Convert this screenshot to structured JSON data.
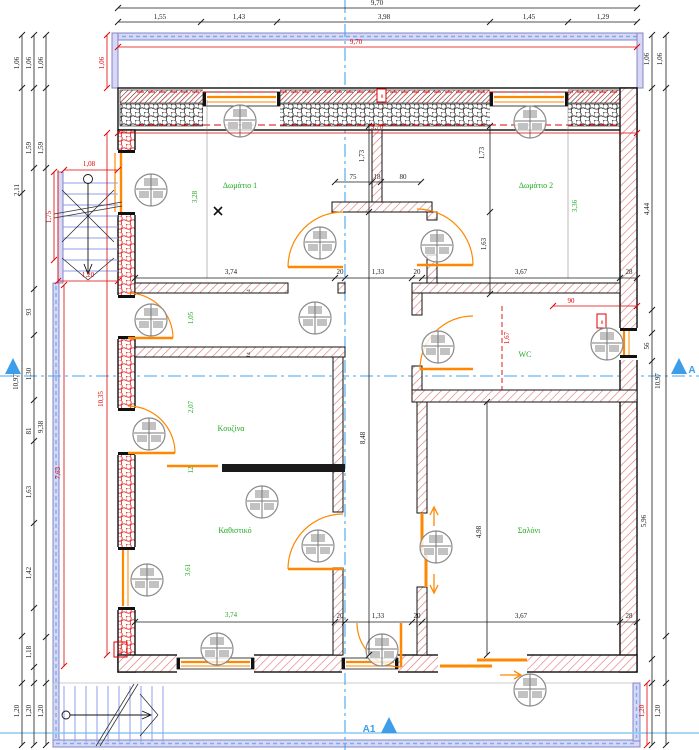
{
  "colors": {
    "dim_black": "#1a1a1a",
    "dim_red": "#e00000",
    "room_green": "#1faa1f",
    "section_blue": "#3d9de8",
    "door_orange": "#ff8800",
    "rail_purple": "#8585c8",
    "wall_hatch_red": "#e07070",
    "stair_tread_blue": "#8f9fe8"
  },
  "rooms": [
    {
      "label": "Δωμάτιο 1",
      "x": 240,
      "y": 188
    },
    {
      "label": "Δωμάτιο 2",
      "x": 536,
      "y": 188
    },
    {
      "label": "WC",
      "x": 525,
      "y": 357
    },
    {
      "label": "Κουζίνα",
      "x": 231,
      "y": 431
    },
    {
      "label": "Καθιστικό",
      "x": 235,
      "y": 533
    },
    {
      "label": "Σαλόνι",
      "x": 529,
      "y": 533
    }
  ],
  "markers": [
    {
      "t": "A",
      "x": 692,
      "y": 373
    },
    {
      "t": "A1",
      "x": 369,
      "y": 732
    }
  ],
  "dims": [
    {
      "t": "9,70",
      "x": 377,
      "y": 5,
      "c": "k"
    },
    {
      "t": "1,55",
      "x": 160,
      "y": 19,
      "c": "k"
    },
    {
      "t": "1,43",
      "x": 239,
      "y": 19,
      "c": "k"
    },
    {
      "t": "3,98",
      "x": 384,
      "y": 19,
      "c": "k"
    },
    {
      "t": "1,45",
      "x": 529,
      "y": 19,
      "c": "k"
    },
    {
      "t": "1,29",
      "x": 603,
      "y": 19,
      "c": "k"
    },
    {
      "t": "1,06",
      "x": 19,
      "y": 63,
      "r": 1,
      "c": "k"
    },
    {
      "t": "1,06",
      "x": 31,
      "y": 63,
      "r": 1,
      "c": "k"
    },
    {
      "t": "1,06",
      "x": 43,
      "y": 63,
      "r": 1,
      "c": "k"
    },
    {
      "t": "1,59",
      "x": 31,
      "y": 148,
      "r": 1,
      "c": "k"
    },
    {
      "t": "1,59",
      "x": 43,
      "y": 148,
      "r": 1,
      "c": "k"
    },
    {
      "t": "2,11",
      "x": 19,
      "y": 190,
      "r": 1,
      "c": "k"
    },
    {
      "t": "93",
      "x": 31,
      "y": 312,
      "r": 1,
      "c": "k"
    },
    {
      "t": "1,30",
      "x": 31,
      "y": 374,
      "r": 1,
      "c": "k"
    },
    {
      "t": "81",
      "x": 31,
      "y": 431,
      "r": 1,
      "c": "k"
    },
    {
      "t": "1,63",
      "x": 31,
      "y": 492,
      "r": 1,
      "c": "k"
    },
    {
      "t": "1,42",
      "x": 31,
      "y": 573,
      "r": 1,
      "c": "k"
    },
    {
      "t": "1,18",
      "x": 31,
      "y": 652,
      "r": 1,
      "c": "k"
    },
    {
      "t": "9,38",
      "x": 43,
      "y": 427,
      "r": 1,
      "c": "k"
    },
    {
      "t": "10,97",
      "x": 18,
      "y": 382,
      "r": 1,
      "c": "k"
    },
    {
      "t": "1,20",
      "x": 19,
      "y": 711,
      "r": 1,
      "c": "k"
    },
    {
      "t": "1,20",
      "x": 31,
      "y": 711,
      "r": 1,
      "c": "k"
    },
    {
      "t": "1,20",
      "x": 43,
      "y": 711,
      "r": 1,
      "c": "k"
    },
    {
      "t": "1,06",
      "x": 649,
      "y": 59,
      "r": 1,
      "c": "k"
    },
    {
      "t": "1,06",
      "x": 662,
      "y": 59,
      "r": 1,
      "c": "k"
    },
    {
      "t": "4,44",
      "x": 649,
      "y": 209,
      "r": 1,
      "c": "k"
    },
    {
      "t": "56",
      "x": 649,
      "y": 346,
      "r": 1,
      "c": "k"
    },
    {
      "t": "10,97",
      "x": 660,
      "y": 381,
      "r": 1,
      "c": "k"
    },
    {
      "t": "5,96",
      "x": 646,
      "y": 521,
      "r": 1,
      "c": "k"
    },
    {
      "t": "1,20",
      "x": 660,
      "y": 711,
      "r": 1,
      "c": "k"
    },
    {
      "t": "28",
      "x": 629,
      "y": 274,
      "c": "k"
    },
    {
      "t": "28",
      "x": 629,
      "y": 618,
      "c": "k"
    },
    {
      "t": "3,74",
      "x": 231,
      "y": 274,
      "c": "k"
    },
    {
      "t": "20",
      "x": 340,
      "y": 274,
      "c": "k"
    },
    {
      "t": "1,33",
      "x": 378,
      "y": 274,
      "c": "k"
    },
    {
      "t": "20",
      "x": 417,
      "y": 274,
      "c": "k"
    },
    {
      "t": "3,67",
      "x": 521,
      "y": 274,
      "c": "k"
    },
    {
      "t": "1,33",
      "x": 378,
      "y": 618,
      "c": "k"
    },
    {
      "t": "3,67",
      "x": 521,
      "y": 618,
      "c": "k"
    },
    {
      "t": "20",
      "x": 340,
      "y": 618,
      "c": "k"
    },
    {
      "t": "20",
      "x": 417,
      "y": 618,
      "c": "k"
    },
    {
      "t": "75",
      "x": 353,
      "y": 179,
      "c": "k"
    },
    {
      "t": "18",
      "x": 377,
      "y": 179,
      "c": "k"
    },
    {
      "t": "80",
      "x": 403,
      "y": 179,
      "c": "k"
    },
    {
      "t": "1,73",
      "x": 364,
      "y": 156,
      "r": 1,
      "c": "k"
    },
    {
      "t": "1,73",
      "x": 484,
      "y": 153,
      "r": 1,
      "c": "k"
    },
    {
      "t": "1,63",
      "x": 486,
      "y": 244,
      "r": 1,
      "c": "k"
    },
    {
      "t": "8,48",
      "x": 365,
      "y": 438,
      "r": 1,
      "c": "k"
    },
    {
      "t": "4,98",
      "x": 481,
      "y": 532,
      "r": 1,
      "c": "k"
    },
    {
      "t": "14",
      "x": 250,
      "y": 292,
      "r": 1,
      "c": "k",
      "s": 5.5
    },
    {
      "t": "14",
      "x": 250,
      "y": 355,
      "r": 1,
      "c": "k",
      "s": 5.5
    },
    {
      "t": "3,28",
      "x": 197,
      "y": 197,
      "r": 1,
      "c": "g"
    },
    {
      "t": "3,36",
      "x": 577,
      "y": 206,
      "r": 1,
      "c": "g"
    },
    {
      "t": "1,05",
      "x": 193,
      "y": 318,
      "r": 1,
      "c": "g"
    },
    {
      "t": "2,07",
      "x": 193,
      "y": 407,
      "r": 1,
      "c": "g"
    },
    {
      "t": "12",
      "x": 193,
      "y": 470,
      "r": 1,
      "c": "g"
    },
    {
      "t": "3,61",
      "x": 190,
      "y": 570,
      "r": 1,
      "c": "g"
    },
    {
      "t": "3,74",
      "x": 231,
      "y": 617,
      "c": "g"
    },
    {
      "t": "9,70",
      "x": 356,
      "y": 44,
      "c": "r"
    },
    {
      "t": "9,70",
      "x": 377,
      "y": 129,
      "c": "r"
    },
    {
      "t": "1,06",
      "x": 104,
      "y": 63,
      "r": 1,
      "c": "r"
    },
    {
      "t": "1,08",
      "x": 89,
      "y": 166,
      "c": "r"
    },
    {
      "t": "1,75",
      "x": 51,
      "y": 217,
      "r": 1,
      "c": "r"
    },
    {
      "t": "1,20",
      "x": 88,
      "y": 277,
      "c": "r"
    },
    {
      "t": "10,35",
      "x": 103,
      "y": 399,
      "r": 1,
      "c": "r"
    },
    {
      "t": "7,63",
      "x": 60,
      "y": 473,
      "r": 1,
      "c": "r"
    },
    {
      "t": "90",
      "x": 571,
      "y": 303,
      "c": "r"
    },
    {
      "t": "1,67",
      "x": 509,
      "y": 338,
      "r": 1,
      "c": "r"
    },
    {
      "t": "1,20",
      "x": 644,
      "y": 711,
      "r": 1,
      "c": "r"
    },
    {
      "t": "102",
      "x": 121,
      "y": 651,
      "r": 1,
      "c": "r",
      "s": 5
    },
    {
      "t": "8",
      "x": 382,
      "y": 98,
      "c": "r",
      "s": 5.5
    },
    {
      "t": "8",
      "x": 602,
      "y": 324,
      "c": "r",
      "s": 5.5
    }
  ]
}
